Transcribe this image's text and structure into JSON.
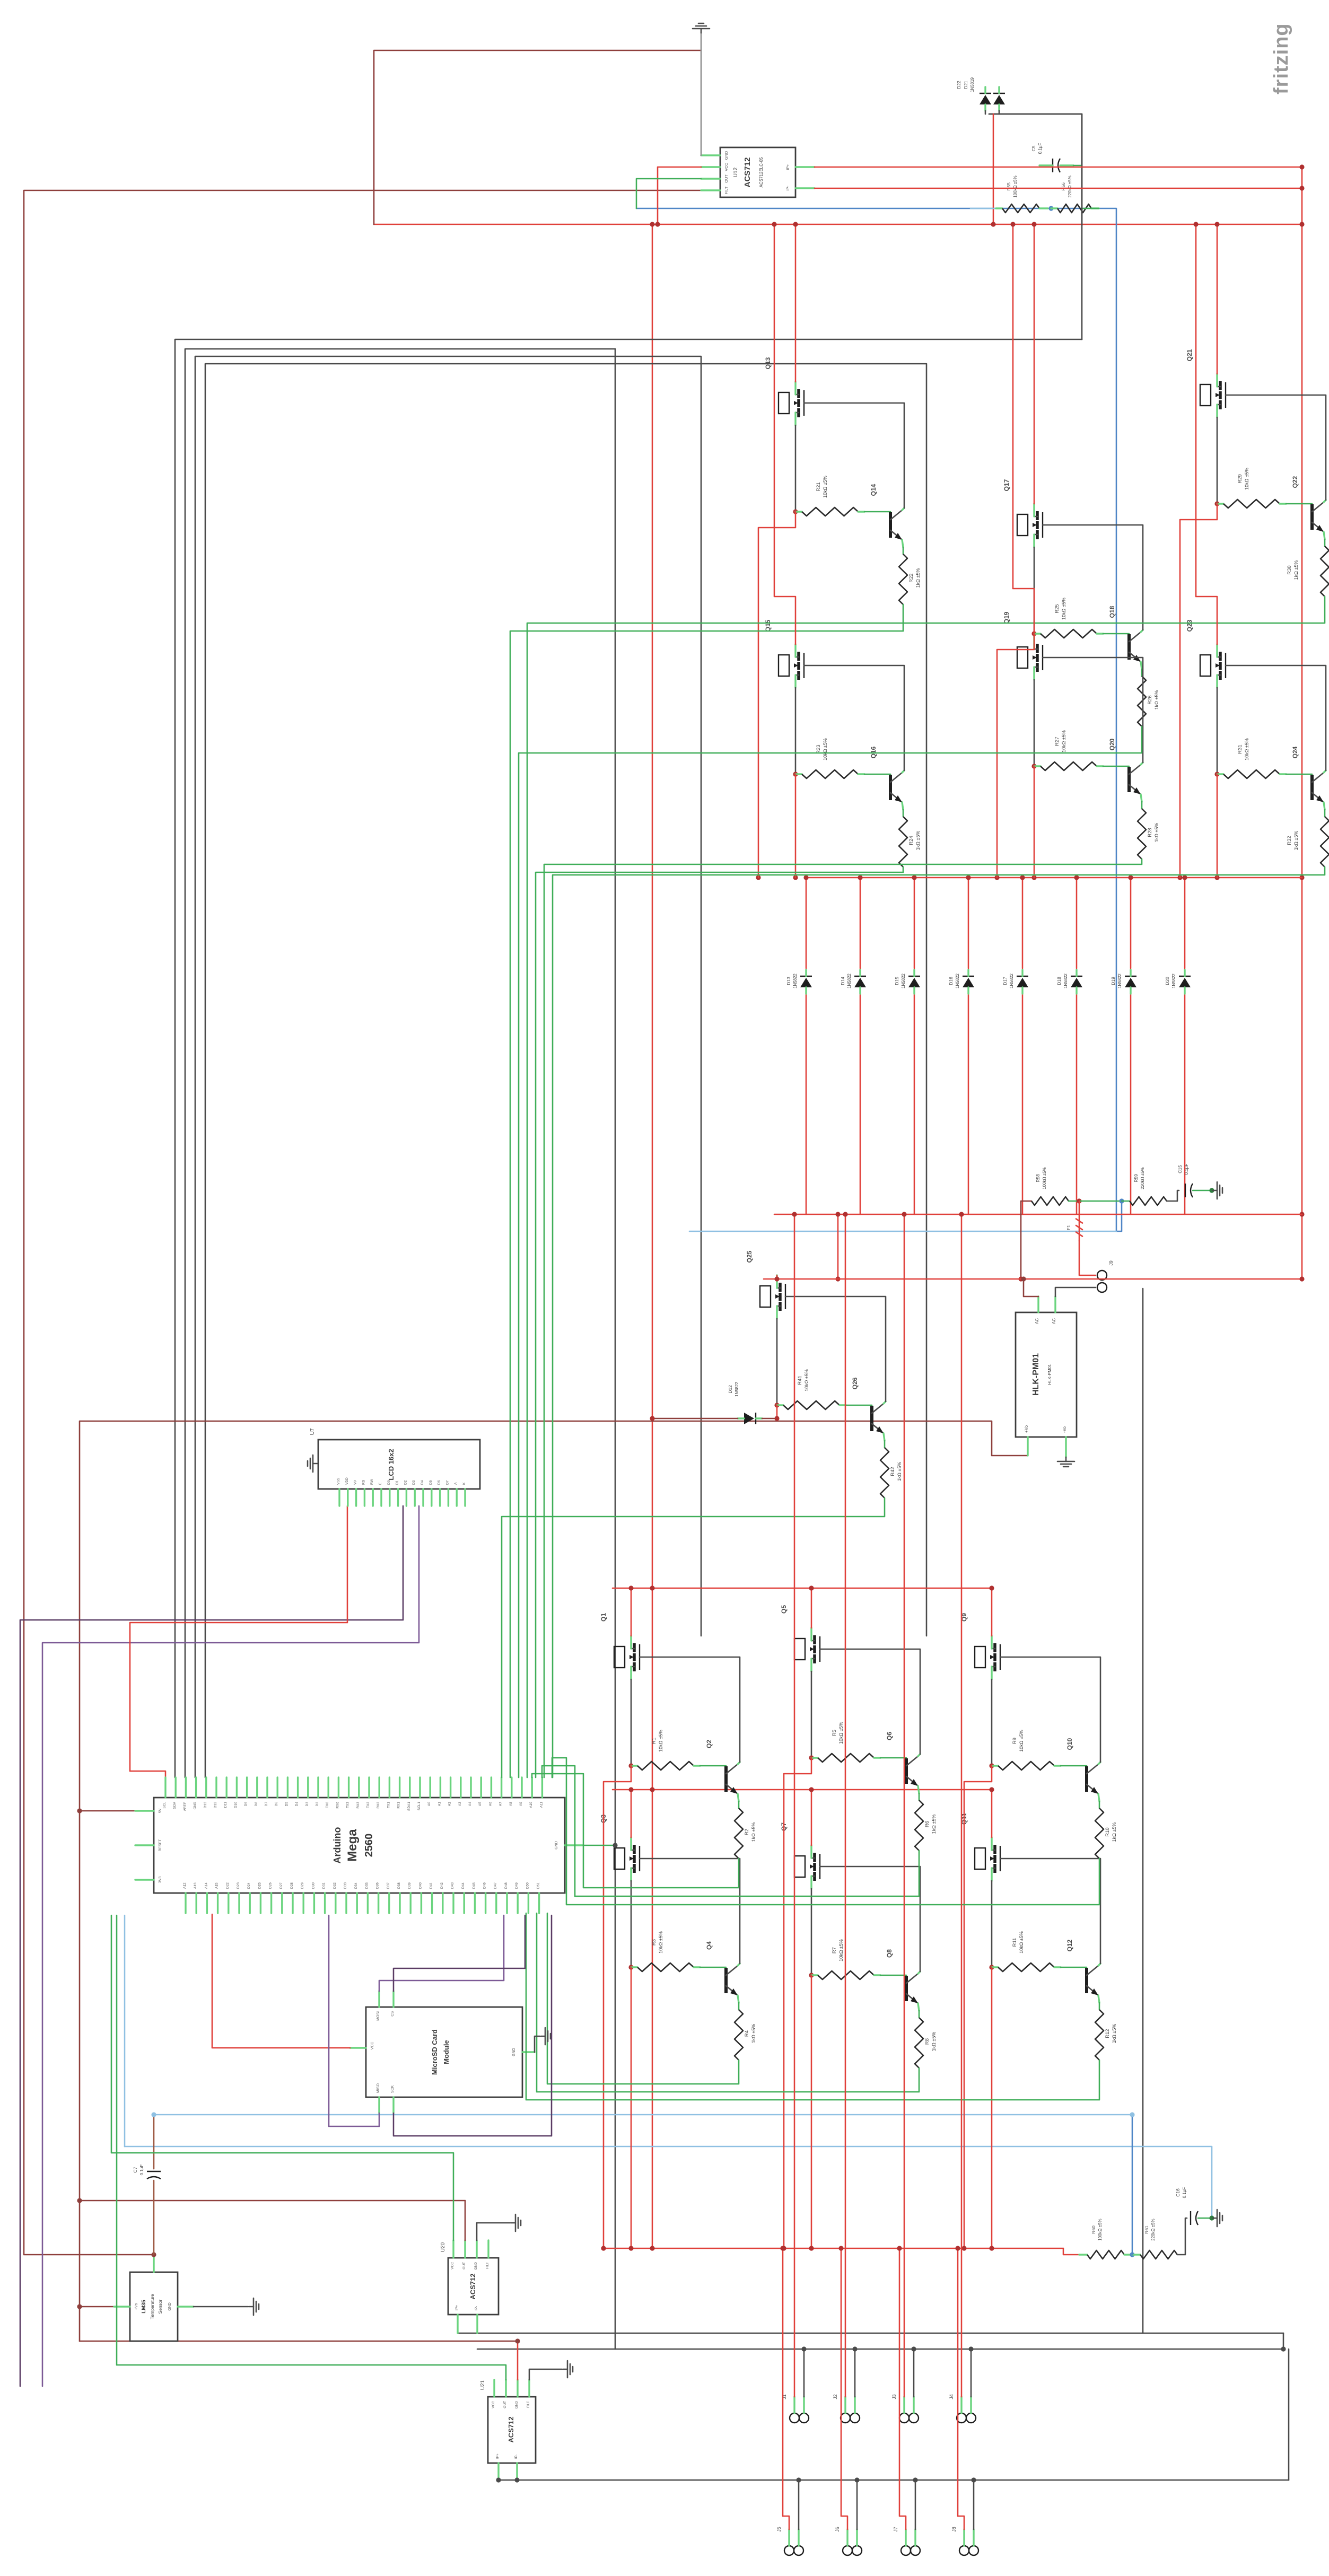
{
  "watermark": "fritzing",
  "colors": {
    "wire_red": "#e0403a",
    "wire_dark_red": "#8e3f3c",
    "wire_black": "#4a4a4a",
    "wire_green": "#3fae58",
    "wire_blue": "#4f86c6",
    "wire_purple": "#7c5a96",
    "wire_brown": "#9c5740",
    "pin_stub": "#6ad47e",
    "watermark_gray": "#9a9a9a"
  },
  "components": {
    "acs1": {
      "ref": "U12",
      "name": "ACS712",
      "sub": "ACS712ELC-05",
      "pins_left": [
        "GND",
        "VCC",
        "OUT",
        "FILT"
      ],
      "pins_right": [
        "IP+",
        "IP-"
      ]
    },
    "acs2": {
      "ref": "U20",
      "name": "ACS712",
      "pins_top": [
        "VCC",
        "OUT",
        "GND",
        "FILT"
      ],
      "pins_bottom": [
        "IP+",
        "IP-"
      ]
    },
    "acs3": {
      "ref": "U21",
      "name": "ACS712",
      "pins_top": [
        "VCC",
        "OUT",
        "GND",
        "FILT"
      ],
      "pins_bottom": [
        "IP+",
        "IP-"
      ]
    },
    "hlk": {
      "name": "HLK-PM01",
      "sub": "HLK-PM01",
      "pins": {
        "ac1": "AC",
        "ac2": "AC",
        "vop": "+Vo",
        "von": "-Vo"
      }
    },
    "arduino": {
      "line1": "Arduino",
      "line2": "Mega",
      "line3": "2560",
      "pins_top": [
        "SCL",
        "SDA",
        "AREF",
        "GND",
        "D13",
        "D12",
        "D11",
        "D10",
        "D9",
        "D8",
        "D7",
        "D6",
        "D5",
        "D4",
        "D3",
        "D2",
        "TX0",
        "RX0",
        "TX3",
        "RX3",
        "TX2",
        "RX2",
        "TX1",
        "RX1",
        "SDA1",
        "SCL1",
        "A0",
        "A1",
        "A2",
        "A3",
        "A4",
        "A5",
        "A6",
        "A7",
        "A8",
        "A9",
        "A10",
        "A11"
      ],
      "pins_bottom": [
        "A12",
        "A13",
        "A14",
        "A15",
        "D22",
        "D23",
        "D24",
        "D25",
        "D26",
        "D27",
        "D28",
        "D29",
        "D30",
        "D31",
        "D32",
        "D33",
        "D34",
        "D35",
        "D36",
        "D37",
        "D38",
        "D39",
        "D40",
        "D41",
        "D42",
        "D43",
        "D44",
        "D45",
        "D46",
        "D47",
        "D48",
        "D49",
        "D50",
        "D51"
      ],
      "pins_left": [
        "5V",
        "RESET",
        "3V3"
      ],
      "pins_right": [
        "GND"
      ]
    },
    "microsd": {
      "line1": "MicroSD Card",
      "line2": "Module",
      "pins": {
        "top": [
          "MOSI",
          "CS"
        ],
        "left": [
          "VCC"
        ],
        "bottom": [
          "MISO",
          "SCK"
        ],
        "right": [
          "GND"
        ]
      }
    },
    "lm35": {
      "line1": "LM35",
      "line2": "Temperature",
      "line3": "Sensor",
      "pins": {
        "left": "+Vs",
        "right": "GND"
      }
    },
    "lcd": {
      "ref": "U7",
      "name": "LCD 16x2",
      "pins": [
        "VSS",
        "VDD",
        "V0",
        "RS",
        "RW",
        "E",
        "D0",
        "D1",
        "D2",
        "D3",
        "D4",
        "D5",
        "D6",
        "D7",
        "A",
        "K"
      ]
    },
    "fuse": {
      "ref": "F1"
    },
    "ac_connector": {
      "ref": "J9"
    }
  },
  "mosfet_cells": {
    "r_gate_value": "10kΩ ±5%",
    "r_base_value": "1kΩ ±5%",
    "upper": [
      {
        "m": "Q13",
        "n": "Q14",
        "rg": "R21",
        "rb": "R22"
      },
      {
        "m": "Q17",
        "n": "Q18",
        "rg": "R25",
        "rb": "R26"
      },
      {
        "m": "Q21",
        "n": "Q22",
        "rg": "R29",
        "rb": "R30"
      },
      {
        "m": "Q15",
        "n": "Q16",
        "rg": "R23",
        "rb": "R24"
      },
      {
        "m": "Q19",
        "n": "Q20",
        "rg": "R27",
        "rb": "R28"
      },
      {
        "m": "Q23",
        "n": "Q24",
        "rg": "R31",
        "rb": "R32"
      }
    ],
    "lower": [
      {
        "m": "Q1",
        "n": "Q2",
        "rg": "R1",
        "rb": "R2"
      },
      {
        "m": "Q5",
        "n": "Q6",
        "rg": "R5",
        "rb": "R6"
      },
      {
        "m": "Q9",
        "n": "Q10",
        "rg": "R9",
        "rb": "R10"
      },
      {
        "m": "Q3",
        "n": "Q4",
        "rg": "R3",
        "rb": "R4"
      },
      {
        "m": "Q7",
        "n": "Q8",
        "rg": "R7",
        "rb": "R8"
      },
      {
        "m": "Q11",
        "n": "Q12",
        "rg": "R11",
        "rb": "R12"
      }
    ],
    "aux": {
      "m": "Q25",
      "n": "Q26",
      "rg": "R41",
      "rb": "R42"
    }
  },
  "diode_bank": {
    "items": [
      {
        "ref": "D13",
        "part": "1N5822"
      },
      {
        "ref": "D14",
        "part": "1N5822"
      },
      {
        "ref": "D15",
        "part": "1N5822"
      },
      {
        "ref": "D16",
        "part": "1N5822"
      },
      {
        "ref": "D17",
        "part": "1N5822"
      },
      {
        "ref": "D18",
        "part": "1N5822"
      },
      {
        "ref": "D19",
        "part": "1N5822"
      },
      {
        "ref": "D20",
        "part": "1N5822"
      }
    ]
  },
  "d12": {
    "ref": "D12",
    "part": "1N5822"
  },
  "d21": {
    "ref": "D21",
    "part": "1N5819"
  },
  "d22": {
    "ref": "D22",
    "part": "1N5819"
  },
  "rc_top": {
    "c_ref": "C5",
    "c_val": "0.1µF",
    "r1_ref": "R55",
    "r1_val": "100kΩ ±5%",
    "r2_ref": "R56",
    "r2_val": "220kΩ ±5%"
  },
  "rc_mid": {
    "c_ref": "C15",
    "c_val": "0.1µF",
    "r1_ref": "R58",
    "r1_val": "100kΩ ±5%",
    "r2_ref": "R59",
    "r2_val": "220kΩ ±5%"
  },
  "rc_bot": {
    "c_ref": "C16",
    "c_val": "0.1µF",
    "r1_ref": "R60",
    "r1_val": "100kΩ ±5%",
    "r2_ref": "R61",
    "r2_val": "220kΩ ±5%"
  },
  "c_lm35": {
    "ref": "C7",
    "val": "0.1µF"
  },
  "connectors": {
    "ac": "J9",
    "outputs": [
      "J1",
      "J2",
      "J3",
      "J4",
      "J5",
      "J6",
      "J7",
      "J8"
    ]
  }
}
